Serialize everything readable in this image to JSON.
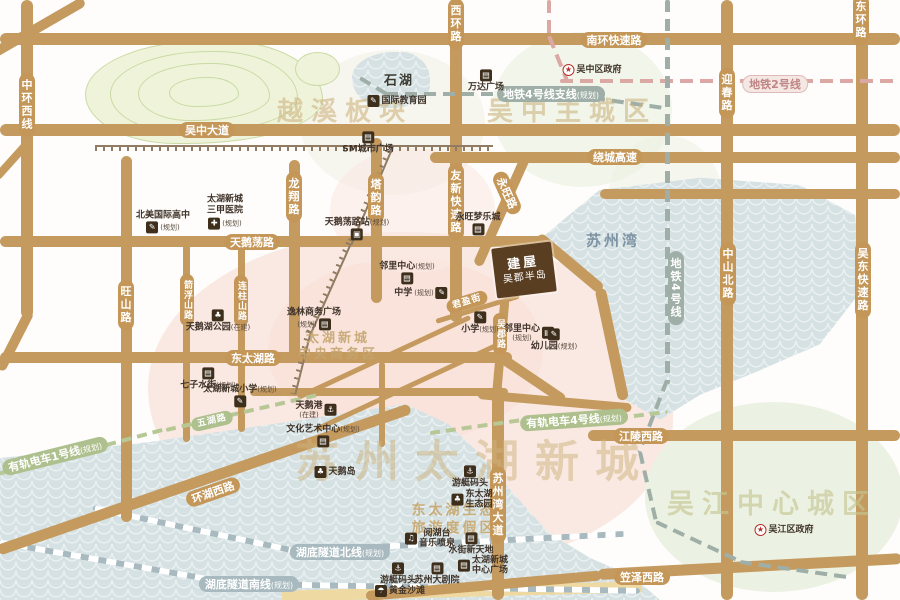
{
  "roads": {
    "zhonghuanxi": {
      "label": "中环西线"
    },
    "wuzhongdadao": {
      "label": "吴中大道"
    },
    "xihuanlu": {
      "label": "西环路"
    },
    "nanhuan": {
      "label": "南环快速路"
    },
    "yingchun": {
      "label": "迎春路"
    },
    "donghuan": {
      "label": "东环路"
    },
    "raocheng": {
      "label": "绕城高速"
    },
    "longxiang": {
      "label": "龙翔路"
    },
    "tayun": {
      "label": "塔韵路"
    },
    "youxin": {
      "label": "友新快速路"
    },
    "yongwang": {
      "label": "永旺路"
    },
    "tianedang": {
      "label": "天鹅荡路"
    },
    "wangshan": {
      "label": "旺山路"
    },
    "jianfushan": {
      "label": "箭浮山路"
    },
    "lianzhushan": {
      "label": "连柱山路"
    },
    "zhongshanbei": {
      "label": "中山北路"
    },
    "wudong": {
      "label": "吴东快速路"
    },
    "dongtaihu": {
      "label": "东太湖路"
    },
    "wujun": {
      "label": "吴郡路"
    },
    "junying": {
      "label": "君盈街"
    },
    "suzhouwandadao": {
      "label": "苏州湾大道"
    },
    "jianglingxi": {
      "label": "江陵西路"
    },
    "wuhu": {
      "label": "五湖路"
    },
    "huanhuxi": {
      "label": "环湖西路"
    },
    "lizexi": {
      "label": "笠泽西路"
    },
    "tunnelN": {
      "label": "湖底隧道北线",
      "suffix": "(规划)"
    },
    "tunnelS": {
      "label": "湖底隧道南线",
      "suffix": "(规划)"
    }
  },
  "transit": {
    "line2": {
      "label": "地铁2号线"
    },
    "line4": {
      "label": "地铁4号线"
    },
    "line4branch": {
      "label": "地铁4号线支线",
      "suffix": "(规划)"
    },
    "tram1": {
      "label": "有轨电车1号线",
      "suffix": "(规划)"
    },
    "tram4": {
      "label": "有轨电车4号线",
      "suffix": "(规划)"
    }
  },
  "watermarks": {
    "yuexi": "越溪板块",
    "wuzhong": "吴中主城区",
    "taihuNewTown": "苏州太湖新城",
    "wujiang": "吴江中心城区",
    "cbd1": "太湖新城",
    "cbd2": "中央商务区",
    "resort1": "东太湖生态",
    "resort2": "旅游度假区",
    "suzhouBay": "苏州湾"
  },
  "pois": {
    "shihu": {
      "label": "石湖"
    },
    "wanda": {
      "label": "万达广场",
      "glyph": "▤"
    },
    "wuzhongGov": {
      "label": "吴中区政府",
      "glyph": "★"
    },
    "intlEdu": {
      "label": "国际教育园",
      "glyph": "✎"
    },
    "smPlaza": {
      "label": "SM城市广场",
      "glyph": "▤"
    },
    "beimei": {
      "label": "北美国际高中",
      "suffix": "(规划)",
      "glyph": "✎"
    },
    "hospital": {
      "l1": "太湖新城",
      "l2": "三甲医院",
      "suffix": "(规划)",
      "glyph": "✚"
    },
    "station": {
      "label": "天鹅荡路站",
      "suffix": "(规划)",
      "glyph": "▣"
    },
    "aeon": {
      "label": "永旺梦乐城",
      "glyph": "▤"
    },
    "linli1": {
      "label": "邻里中心",
      "suffix": "(规划)",
      "glyph": "▤"
    },
    "zhongxue": {
      "label": "中学",
      "suffix": "(规划)",
      "glyph": "✎"
    },
    "yilin": {
      "label": "逸林商务广场",
      "suffix": "(规划)",
      "glyph": "▤"
    },
    "xiaoxue": {
      "label": "小学",
      "suffix": "(规划)",
      "glyph": "✎"
    },
    "linli2": {
      "label": "邻里中心",
      "suffix": "(规划)",
      "glyph": "▤"
    },
    "youeryuan": {
      "label": "幼儿园",
      "suffix": "(规划)",
      "glyph": "✎"
    },
    "qizi": {
      "label": "七子水街",
      "suffix": "(规划)",
      "glyph": "▤"
    },
    "taihuXiaoxue": {
      "label": "太湖新城小学",
      "suffix": "(规划)",
      "glyph": "✎"
    },
    "swanPark": {
      "label": "天鹅湖公园",
      "suffix": "(在建)",
      "glyph": "♣"
    },
    "swanPort": {
      "label": "天鹅港",
      "suffix": "(在建)",
      "glyph": "⚓"
    },
    "culture": {
      "label": "文化艺术中心",
      "suffix": "(规划)",
      "glyph": "▤"
    },
    "swanIsland": {
      "label": "天鹅岛",
      "glyph": "♣"
    },
    "yacht1": {
      "label": "游艇码头",
      "glyph": "⚓"
    },
    "ecoPark": {
      "l1": "东太湖",
      "l2": "生态园",
      "glyph": "♣"
    },
    "yuehutai": {
      "l1": "阅湖台",
      "l2": "音乐喷泉",
      "glyph": "♫"
    },
    "shuijie": {
      "label": "水街新天地",
      "glyph": "▤"
    },
    "centerPlaza": {
      "l1": "太湖新城",
      "l2": "中心广场",
      "glyph": "▤"
    },
    "theater": {
      "label": "苏州大剧院",
      "glyph": "▤"
    },
    "yacht2": {
      "label": "游艇码头",
      "glyph": "⚓"
    },
    "beach": {
      "label": "黄金沙滩",
      "glyph": "☂"
    },
    "wujiangGov": {
      "label": "吴江区政府",
      "glyph": "★"
    }
  },
  "project": {
    "line1": "建屋",
    "line2": "吴郡半岛"
  },
  "colors": {
    "road": "#C59A5F",
    "metro": "#9FAFA8",
    "metro_line2": "#DBA8A4",
    "tram": "#B7C795",
    "tunnel": "#A8BABF",
    "water": "#D5E1E3",
    "urban_pink": "#FAE9E2",
    "green_zone": "#ECF2E3",
    "project_brown": "#5A3E22"
  }
}
